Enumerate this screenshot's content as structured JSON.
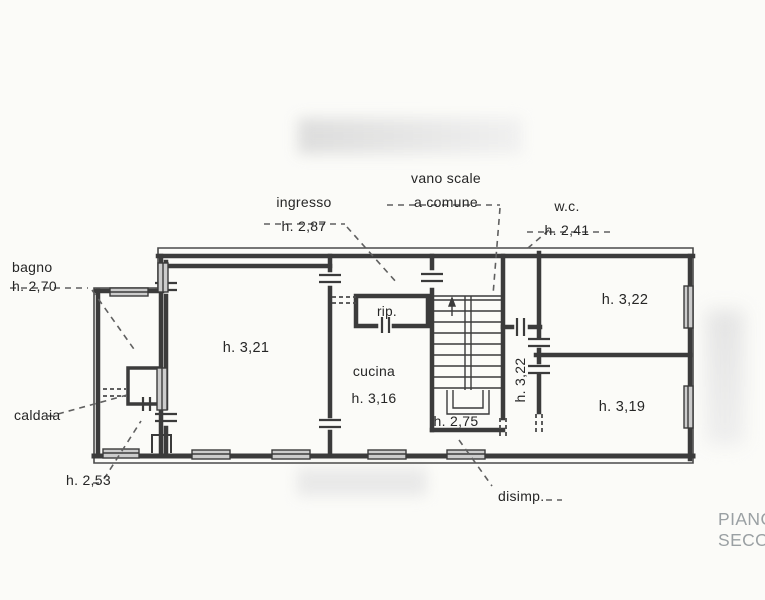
{
  "colors": {
    "paper": "#fbfbf8",
    "line": "#3b3b3b",
    "leader": "#606060",
    "window_fill": "#cccccc",
    "label": "#262626",
    "caption_gray": "#9aa0a3"
  },
  "plan": {
    "rooms": {
      "bagno": {
        "label": "bagno",
        "height": "h. 2,70"
      },
      "caldaia": {
        "label": "caldaia"
      },
      "room_253": {
        "height": "h. 2,53"
      },
      "room_321": {
        "height": "h. 3,21"
      },
      "ingresso": {
        "label": "ingresso",
        "height": "h. 2,87"
      },
      "vano_scale": {
        "label": "vano scale",
        "sublabel": "a comune"
      },
      "rip": {
        "label": "rip."
      },
      "cucina": {
        "label": "cucina",
        "height": "h. 3,16"
      },
      "wc": {
        "label": "w.c.",
        "height": "h. 2,41"
      },
      "room_322": {
        "height": "h. 3,22"
      },
      "room_319": {
        "height": "h. 3,19"
      },
      "corridor_322": {
        "height": "h. 3,22"
      },
      "disimpegno": {
        "label": "disimp.",
        "height": "h. 2,75"
      }
    },
    "caption": {
      "line1": "PIANO",
      "line2": "SECONDO"
    }
  }
}
